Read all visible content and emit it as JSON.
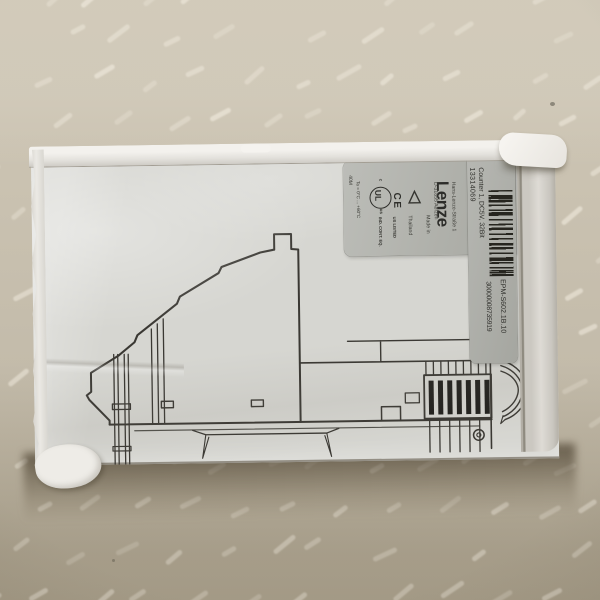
{
  "label": {
    "brand": "Lenze",
    "address_line1": "Hans-Lenze-Straße 1",
    "address_line2": "D-31855 Aerzen",
    "made_in_line1": "Made in",
    "made_in_line2": "Thailand",
    "part_number": "13314069",
    "description": "Counter 1, DC5V, 32Bit",
    "serial_number": "30000008735919",
    "type_code": "EPM-S602.1B.10",
    "temp_rating": "Ta = 0°C ... +60°C",
    "corner_code": "40M",
    "ce_mark": "CE",
    "ul_mark": {
      "letters": "UL",
      "c": "c",
      "us": "us",
      "line1": "US LISTED",
      "line2": "IND. CONT. EQ."
    }
  },
  "colors": {
    "surface": "#c7bfae",
    "surface_smudge": "#f1ebde",
    "box_face": "#d6d6d1",
    "box_wall": "#f3f1ed",
    "label_background": "#b2b3ad",
    "label_text": "#33332e",
    "drawing_line": "#3a3833",
    "barcode": "#26251f",
    "cast_shadow": "#43361f"
  }
}
